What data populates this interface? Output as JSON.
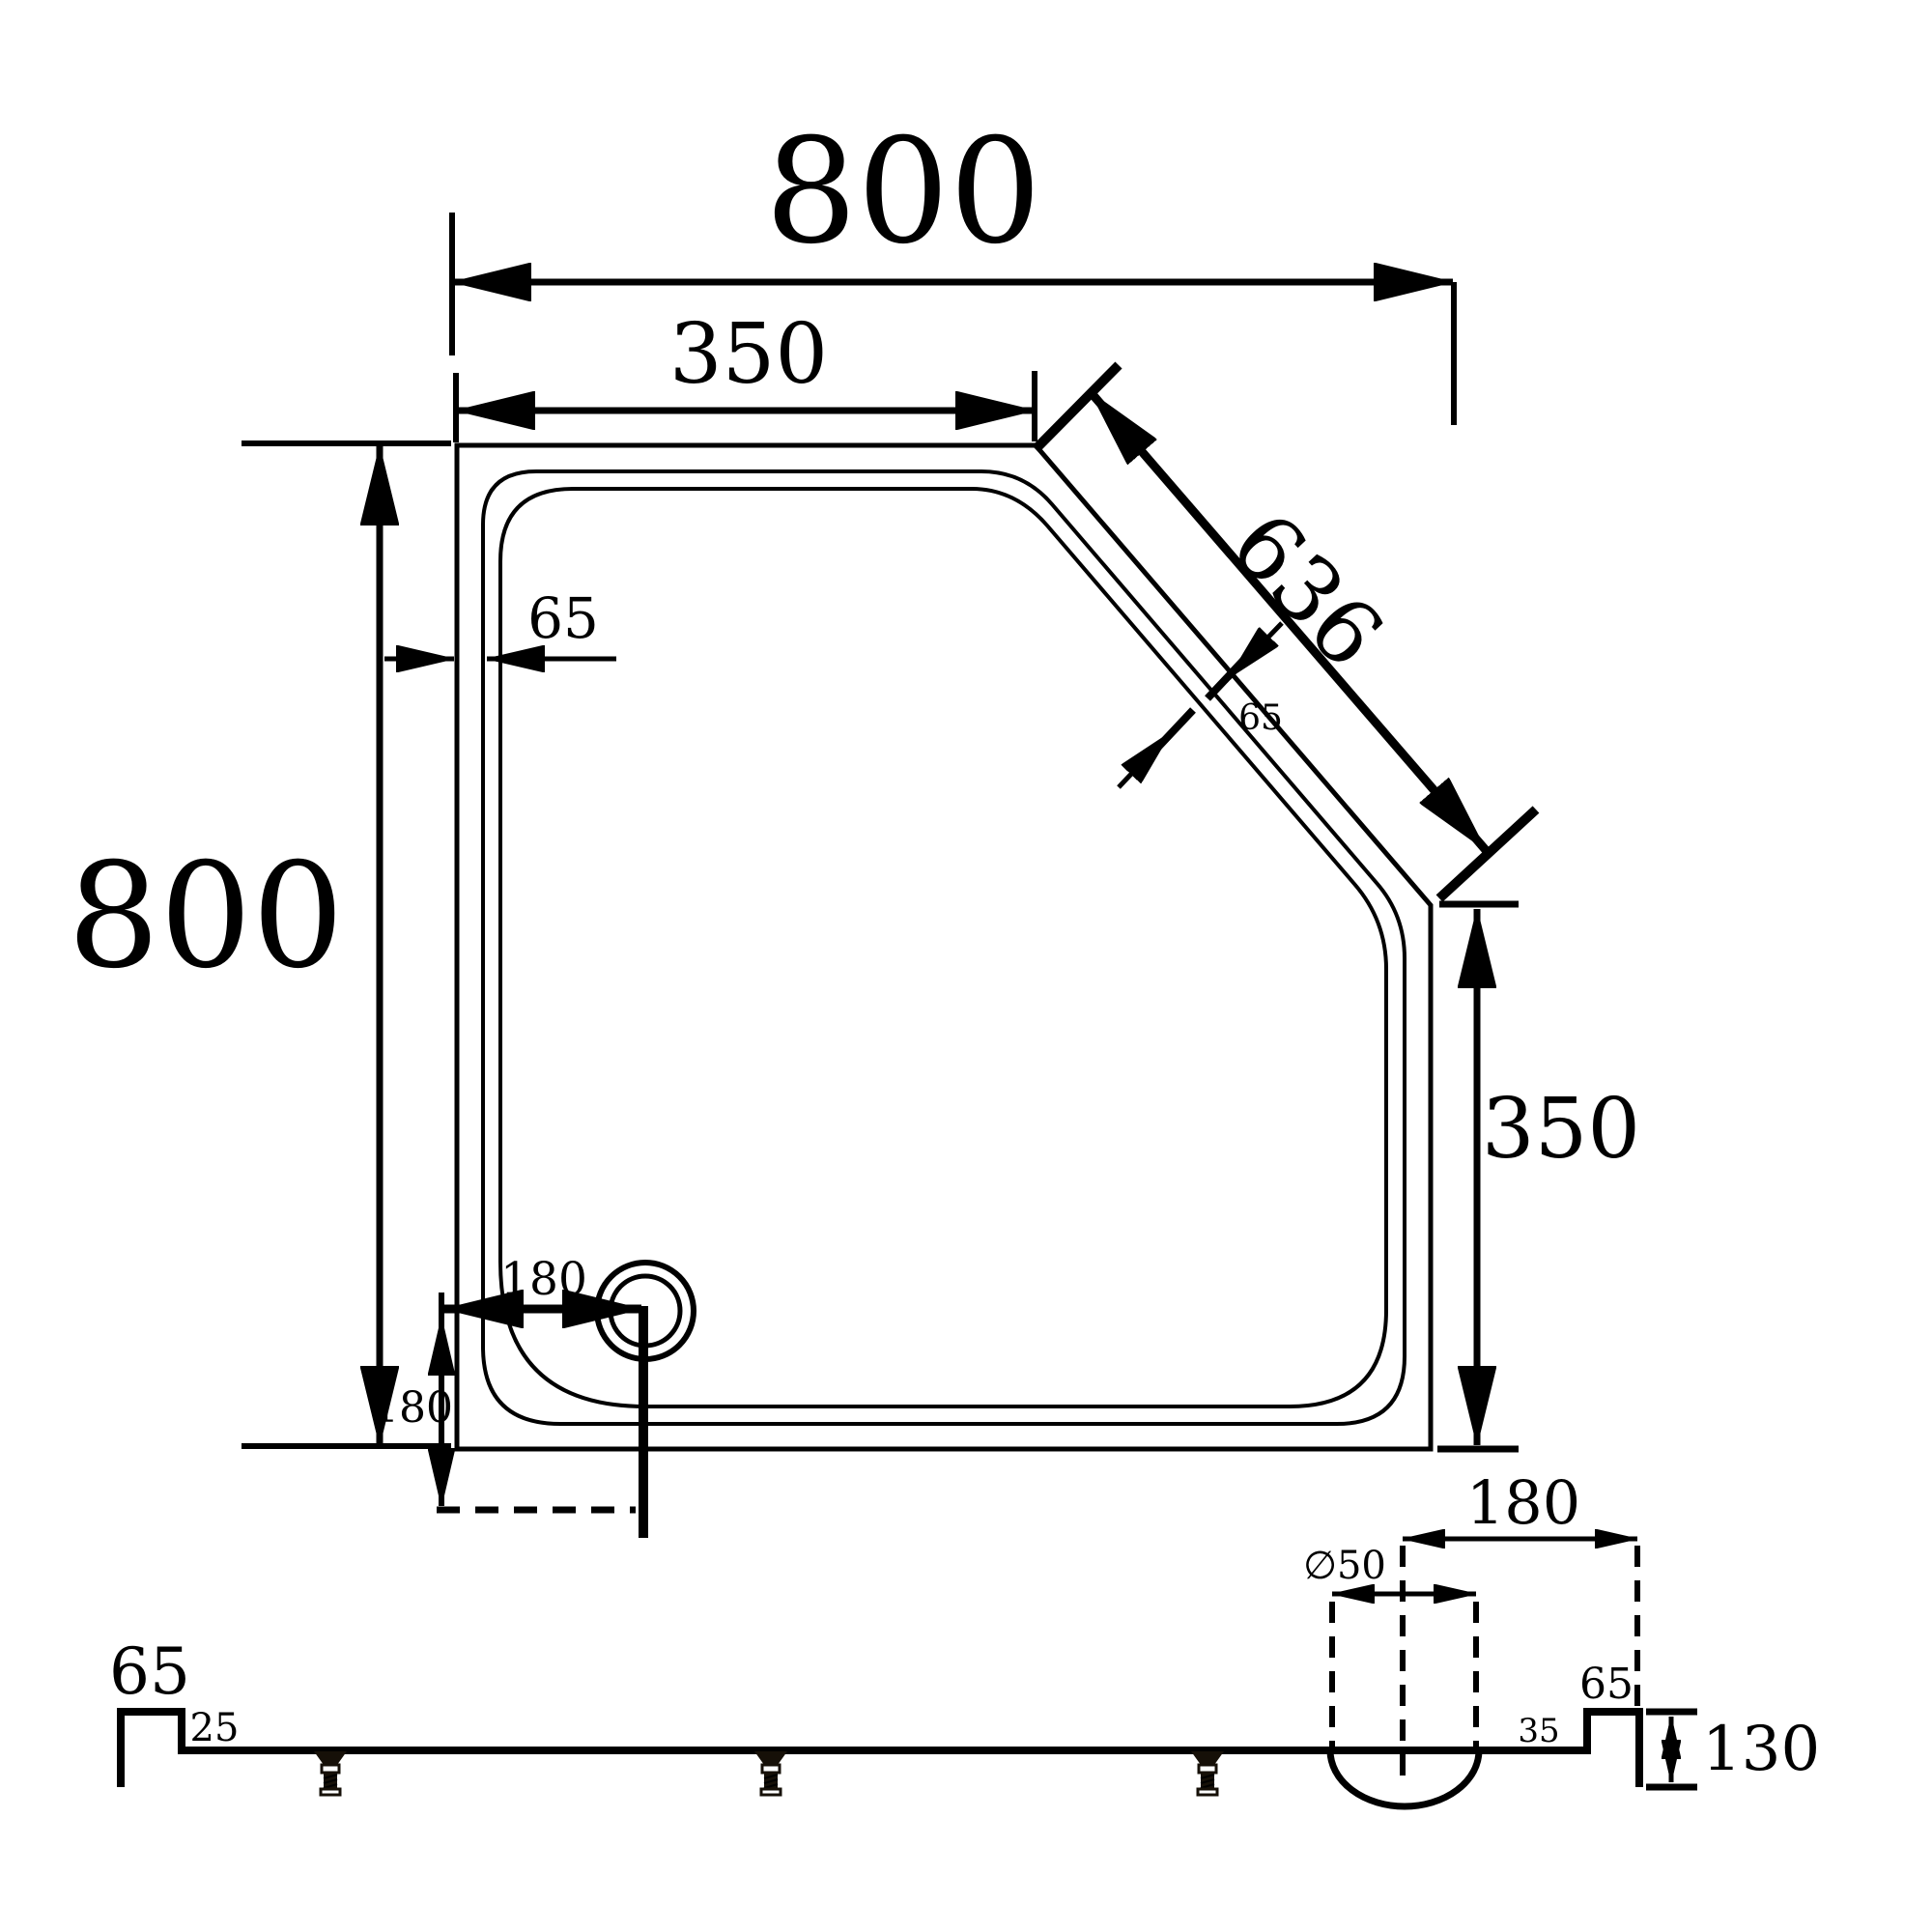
{
  "meta": {
    "description": "Dimensioned engineering drawing of a neo-angle (cut-corner) shower tray: plan view with drain and side section profile",
    "background": "#ffffff",
    "ink": "#000000"
  },
  "plan": {
    "overall_width": "800",
    "overall_height": "800",
    "top_edge_to_cut": "350",
    "right_edge_from_bottom": "350",
    "diagonal_length": "636",
    "rim_width": "65",
    "rim_width_diagonal": "65",
    "drain_offset_x": "180",
    "drain_offset_y": "180"
  },
  "section": {
    "left_upstand_height": "65",
    "left_ledge": "25",
    "right_ledge": "35",
    "right_upstand_height": "65",
    "tray_height": "130",
    "drain_center_to_right_edge": "180",
    "drain_diameter": "∅50"
  }
}
